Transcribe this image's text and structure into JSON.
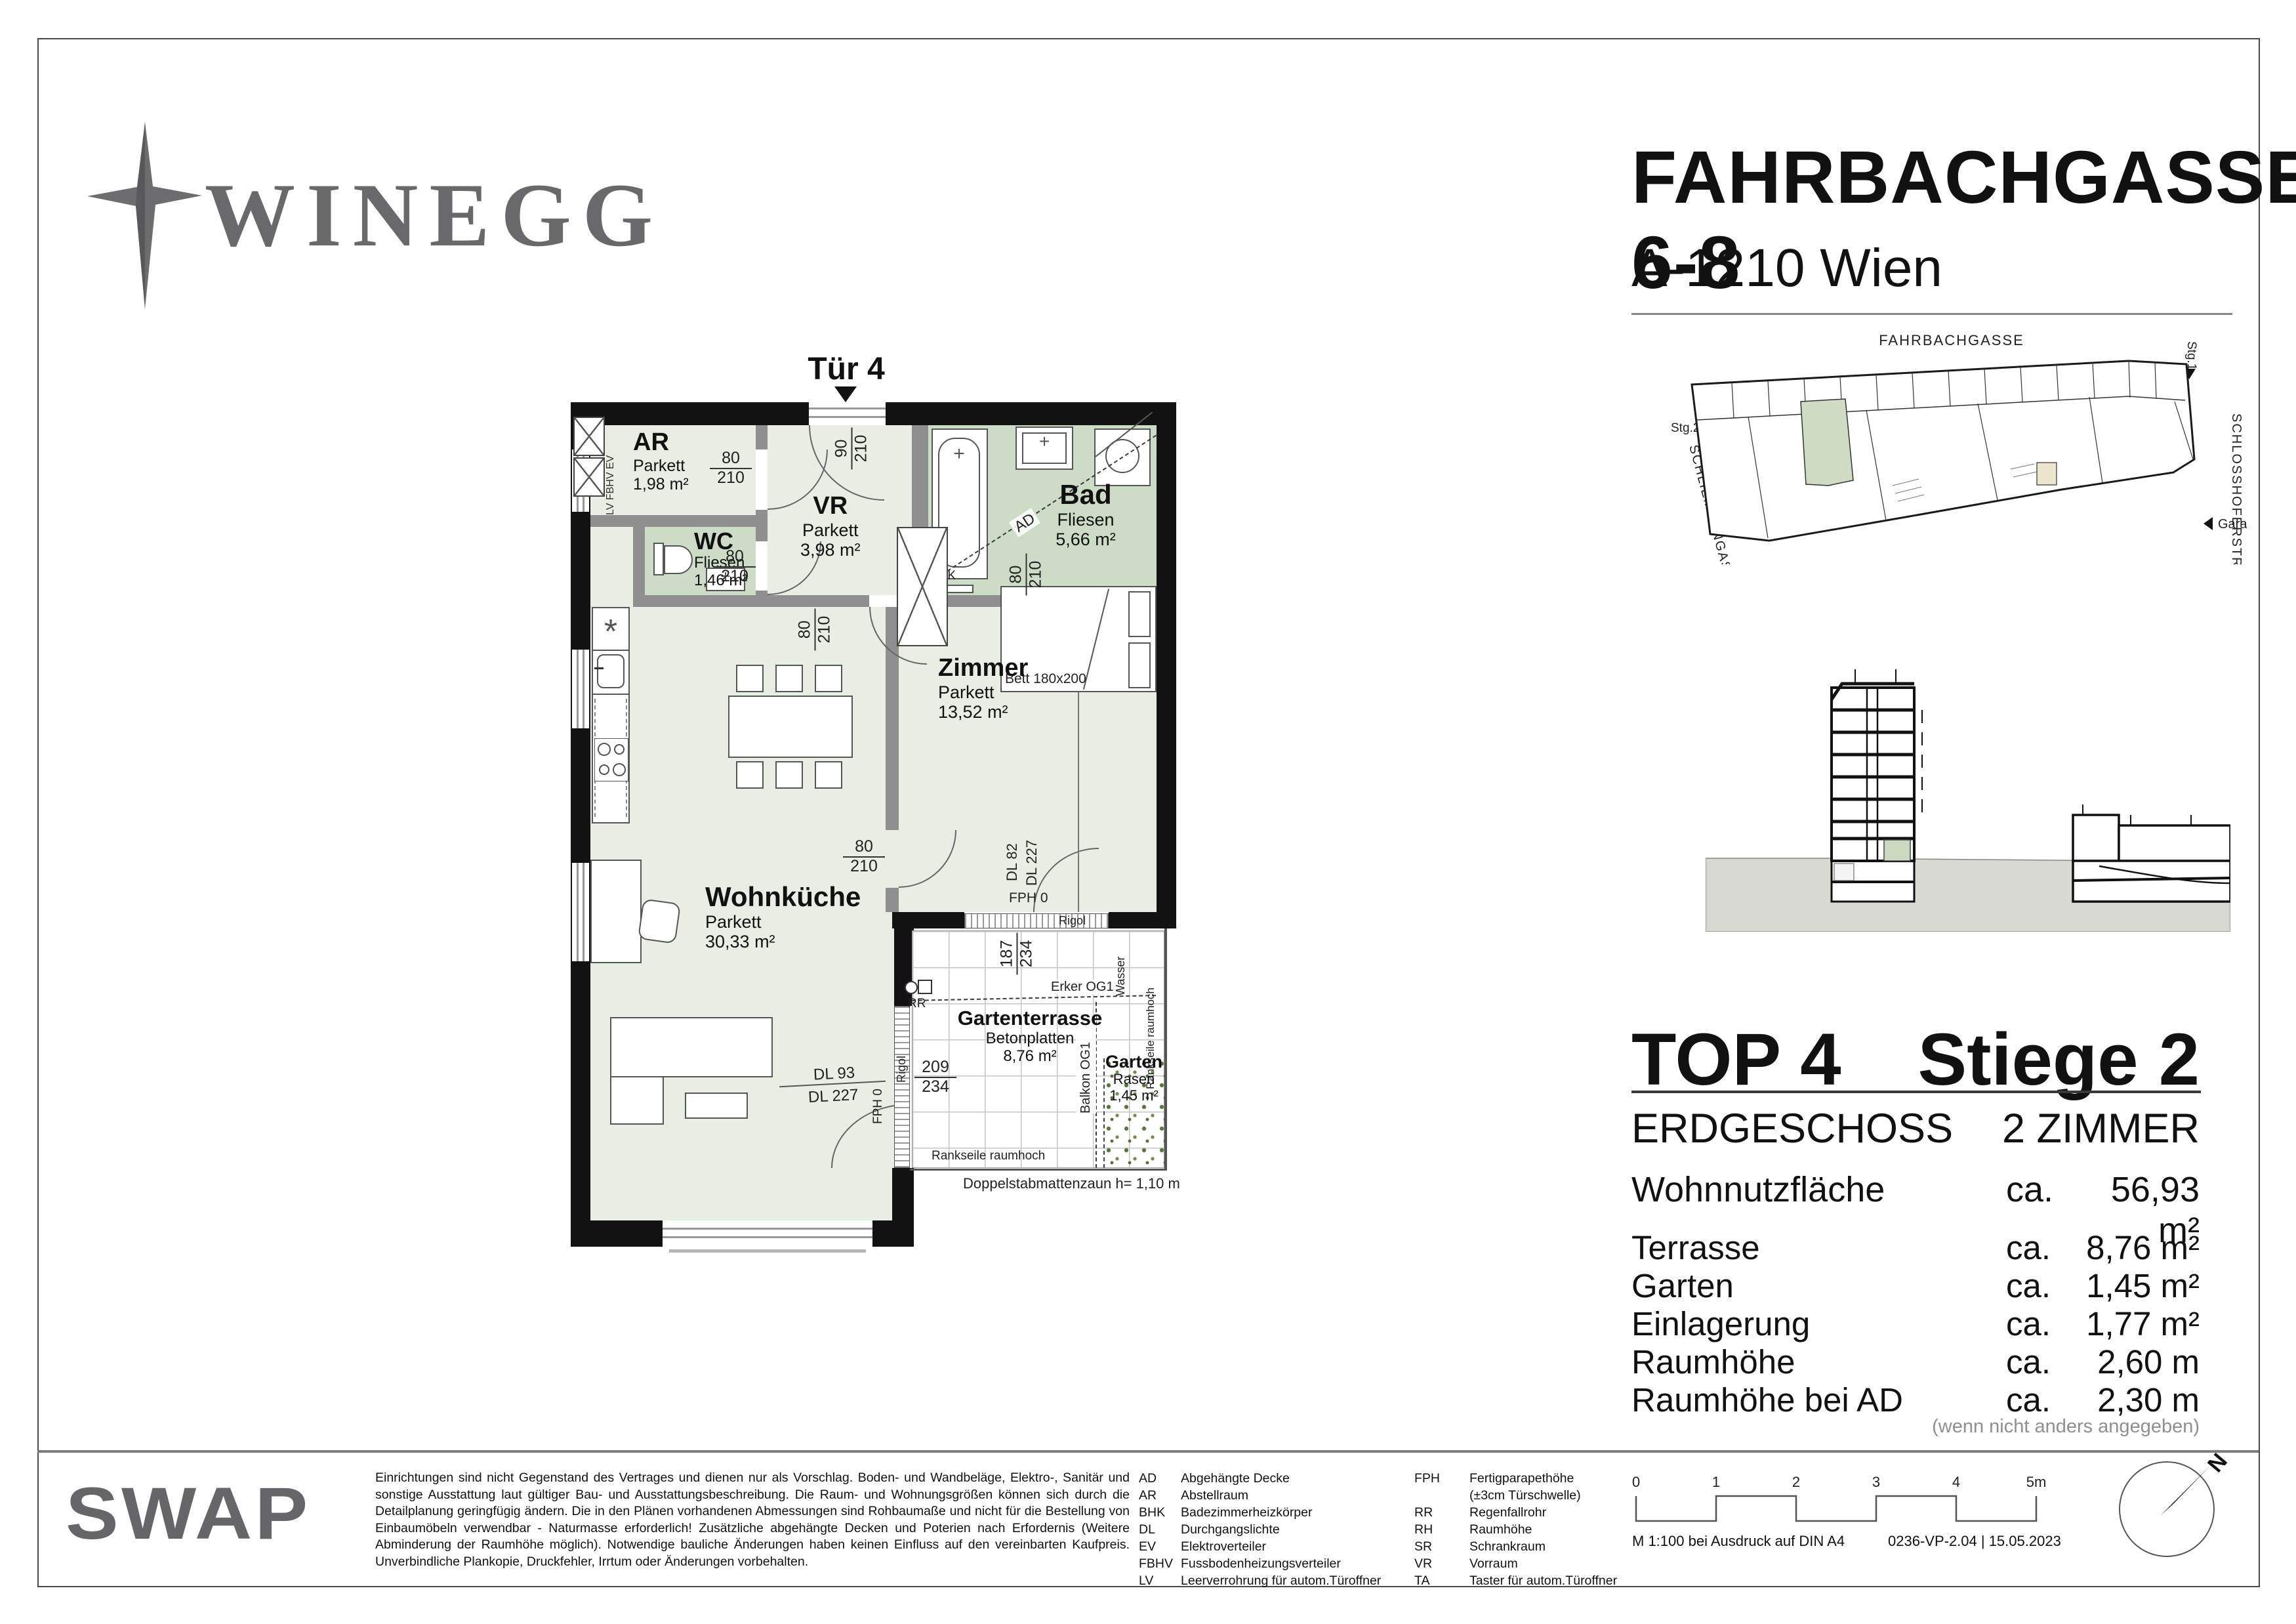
{
  "header": {
    "brand": "WINEGG",
    "title": "FAHRBACHGASSE 6-8",
    "subtitle": "A-1210 Wien"
  },
  "site_plan": {
    "street_top": "FAHRBACHGASSE",
    "street_right": "SCHLOSSHOFERSTR.",
    "street_left": "SCHLIEMANNGASSE",
    "stg1": "Stg.1",
    "stg2": "Stg.2",
    "garage": "Garage"
  },
  "floorplan": {
    "entrance": "Tür 4",
    "rooms": {
      "ar": {
        "name": "AR",
        "floor": "Parkett",
        "area": "1,98 m²"
      },
      "wc": {
        "name": "WC",
        "floor": "Fliesen",
        "area": "1,46 m²"
      },
      "vr": {
        "name": "VR",
        "floor": "Parkett",
        "area": "3,98 m²"
      },
      "bad": {
        "name": "Bad",
        "floor": "Fliesen",
        "area": "5,66 m²"
      },
      "zimmer": {
        "name": "Zimmer",
        "floor": "Parkett",
        "area": "13,52 m²"
      },
      "wohnkueche": {
        "name": "Wohnküche",
        "floor": "Parkett",
        "area": "30,33 m²"
      },
      "terrasse": {
        "name": "Gartenterrasse",
        "floor": "Betonplatten",
        "area": "8,76 m²"
      },
      "garten": {
        "name": "Garten",
        "floor": "Rasen",
        "area": "1,45 m²"
      }
    },
    "dims": {
      "entrance": {
        "w": "90",
        "h": "210"
      },
      "door": {
        "w": "80",
        "h": "210"
      },
      "terrace_a": {
        "w": "187",
        "h": "234"
      },
      "terrace_b": {
        "w": "209",
        "h": "234"
      }
    },
    "annotations": {
      "bett": "Bett 180x200",
      "bhk": "BHK",
      "ad": "AD",
      "rr": "RR",
      "rigol": "Rigol",
      "wasser": "Wasser",
      "erker": "Erker OG1",
      "balkon": "Balkon OG1",
      "rankseile": "Rankseile raumhoch",
      "zaun": "Doppelstabmattenzaun h= 1,10 m",
      "dl82": "DL 82",
      "dl227": "DL 227",
      "dl93": "DL 93",
      "fph0": "FPH 0",
      "ev_stack": "LV FBHV EV"
    }
  },
  "unit_info": {
    "top": "TOP 4",
    "stiege": "Stiege 2",
    "floor_label": "ERDGESCHOSS",
    "rooms_label": "2 ZIMMER",
    "main_row": {
      "label": "Wohnnutzfläche",
      "ca": "ca.",
      "value": "56,93 m²"
    },
    "rows": [
      {
        "label": "Terrasse",
        "ca": "ca.",
        "value": "8,76 m²"
      },
      {
        "label": "Garten",
        "ca": "ca.",
        "value": "1,45 m²"
      },
      {
        "label": "Einlagerung",
        "ca": "ca.",
        "value": "1,77 m²"
      },
      {
        "label": "Raumhöhe",
        "ca": "ca.",
        "value": "2,60 m"
      },
      {
        "label": "Raumhöhe bei AD",
        "ca": "ca.",
        "value": "2,30 m"
      }
    ],
    "note": "(wenn nicht anders angegeben)"
  },
  "footer": {
    "brand": "SWAP",
    "disclaimer": "Einrichtungen sind nicht Gegenstand des Vertrages und dienen nur als Vorschlag. Boden- und Wandbeläge, Elektro-, Sanitär und sonstige Ausstattung laut gültiger Bau- und Ausstattungsbeschreibung. Die Raum- und Wohnungsgrößen können sich durch die Detailplanung geringfügig ändern. Die in den Plänen vorhandenen Abmessungen sind Rohbaumaße und nicht für die Bestellung von Einbaumöbeln verwendbar - Naturmasse erforderlich! Zusätzliche abgehängte Decken und Poterien nach Erfordernis (Weitere Abminderung der Raumhöhe möglich). Notwendige bauliche Änderungen haben keinen Einfluss auf den vereinbarten Kaufpreis. Unverbindliche Plankopie, Druckfehler, Irrtum oder Änderungen vorbehalten.",
    "legend1": [
      {
        "abbr": "AD",
        "term": "Abgehängte Decke"
      },
      {
        "abbr": "AR",
        "term": "Abstellraum"
      },
      {
        "abbr": "BHK",
        "term": "Badezimmerheizkörper"
      },
      {
        "abbr": "DL",
        "term": "Durchgangslichte"
      },
      {
        "abbr": "EV",
        "term": "Elektroverteiler"
      },
      {
        "abbr": "FBHV",
        "term": "Fussbodenheizungsverteiler"
      },
      {
        "abbr": "LV",
        "term": "Leerverrohrung für autom.Türoffner"
      }
    ],
    "legend2": [
      {
        "abbr": "FPH",
        "term": "Fertigparapethöhe"
      },
      {
        "abbr": "",
        "term": "(±3cm Türschwelle)"
      },
      {
        "abbr": "RR",
        "term": "Regenfallrohr"
      },
      {
        "abbr": "RH",
        "term": "Raumhöhe"
      },
      {
        "abbr": "SR",
        "term": "Schrankraum"
      },
      {
        "abbr": "VR",
        "term": "Vorraum"
      },
      {
        "abbr": "TA",
        "term": "Taster für autom.Türoffner"
      }
    ],
    "scale_ticks": [
      "0",
      "1",
      "2",
      "3",
      "4",
      "5m"
    ],
    "print_note": "M 1:100 bei Ausdruck auf DIN A4",
    "doc_ref": "0236-VP-2.04 | 15.05.2023",
    "north": "N"
  }
}
